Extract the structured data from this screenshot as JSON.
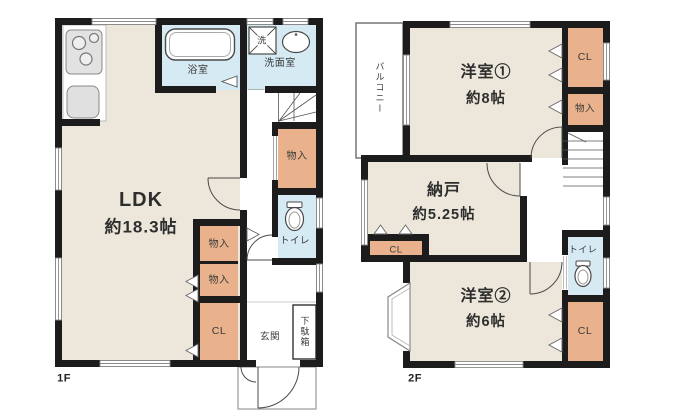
{
  "palette": {
    "wall": "#1c1c1c",
    "room_floor": "#ece7da",
    "storage_floor": "#e9b28c",
    "wet_floor": "#d6eaf3",
    "fixture_stroke": "#4a4a4a",
    "window_stroke": "#8a8a8a"
  },
  "floor1": {
    "floor_label": "1F",
    "ldk": {
      "name": "LDK",
      "area": "約18.3帖"
    },
    "bathroom": {
      "label": "浴室"
    },
    "washroom": {
      "label": "洗面室"
    },
    "washing_machine": {
      "label": "洗"
    },
    "hall_storage": {
      "label": "物入"
    },
    "toilet": {
      "label": "トイレ"
    },
    "storage_upper": {
      "label": "物入"
    },
    "storage_lower": {
      "label": "物入"
    },
    "closet": {
      "label": "CL"
    },
    "entrance": {
      "label": "玄関"
    },
    "shoe_cabinet": {
      "label": "下駄箱"
    }
  },
  "floor2": {
    "floor_label": "2F",
    "balcony": {
      "label": "バルコニー"
    },
    "bedroom1": {
      "name": "洋室①",
      "area": "約8帖"
    },
    "closet1": {
      "label": "CL"
    },
    "storage": {
      "label": "物入"
    },
    "storeroom": {
      "name": "納戸",
      "area": "約5.25帖"
    },
    "storeroom_closet": {
      "label": "CL"
    },
    "toilet": {
      "label": "トイレ"
    },
    "bedroom2": {
      "name": "洋室②",
      "area": "約6帖"
    },
    "closet2": {
      "label": "CL"
    }
  }
}
